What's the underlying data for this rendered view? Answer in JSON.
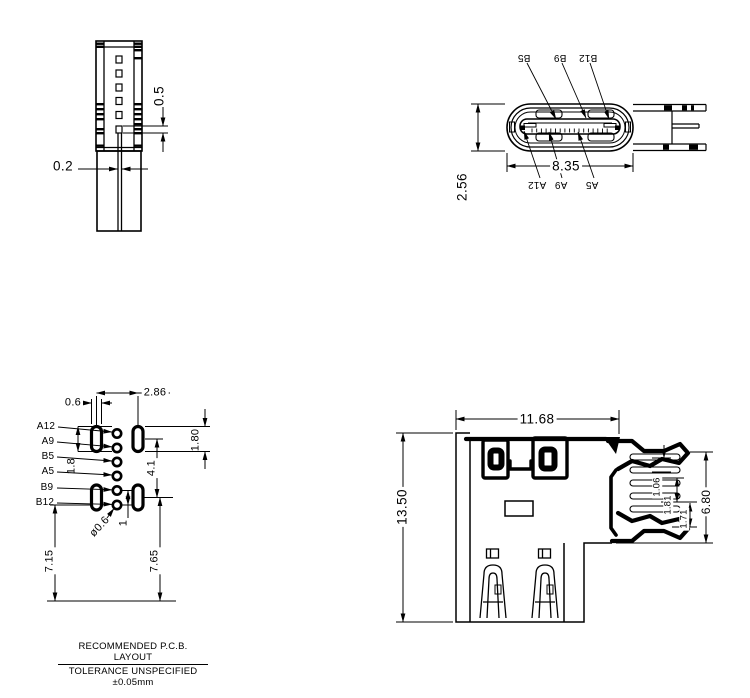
{
  "notes": {
    "line1": "RECOMMENDED  P.C.B.  LAYOUT",
    "line2": "TOLERANCE UNSPECIFIED ±0.05mm"
  },
  "side_view": {
    "dim_pin_height": "0.5",
    "dim_pin_gap": "0.2"
  },
  "front_view": {
    "dim_width": "8.35",
    "dim_height": "2.56",
    "labels": {
      "b5": "B5",
      "b9": "B9",
      "b12": "B12",
      "a12": "A12",
      "a9": "A9",
      "a5": "A5"
    }
  },
  "pcb_view": {
    "labels": {
      "a12": "A12",
      "a9": "A9",
      "b5": "B5",
      "a5": "A5",
      "b9": "B9",
      "b12": "B12"
    },
    "dim_pad_width": "0.6",
    "dim_col_pitch": "2.86",
    "dim_pad_len_left": "1.8",
    "dim_row_span": "4.1",
    "dim_pad_len_right": "1.80",
    "dim_hole_dia": "ø0.6",
    "dim_hole_pitch": "1",
    "dim_left_edge": "7.15",
    "dim_right_edge": "7.65"
  },
  "mount_view": {
    "dim_width": "11.68",
    "dim_height": "13.50",
    "dim_leg_span": "6.80",
    "dim_leg_a": "1.06",
    "dim_leg_b": "1.81",
    "dim_leg_c": "1.71"
  }
}
